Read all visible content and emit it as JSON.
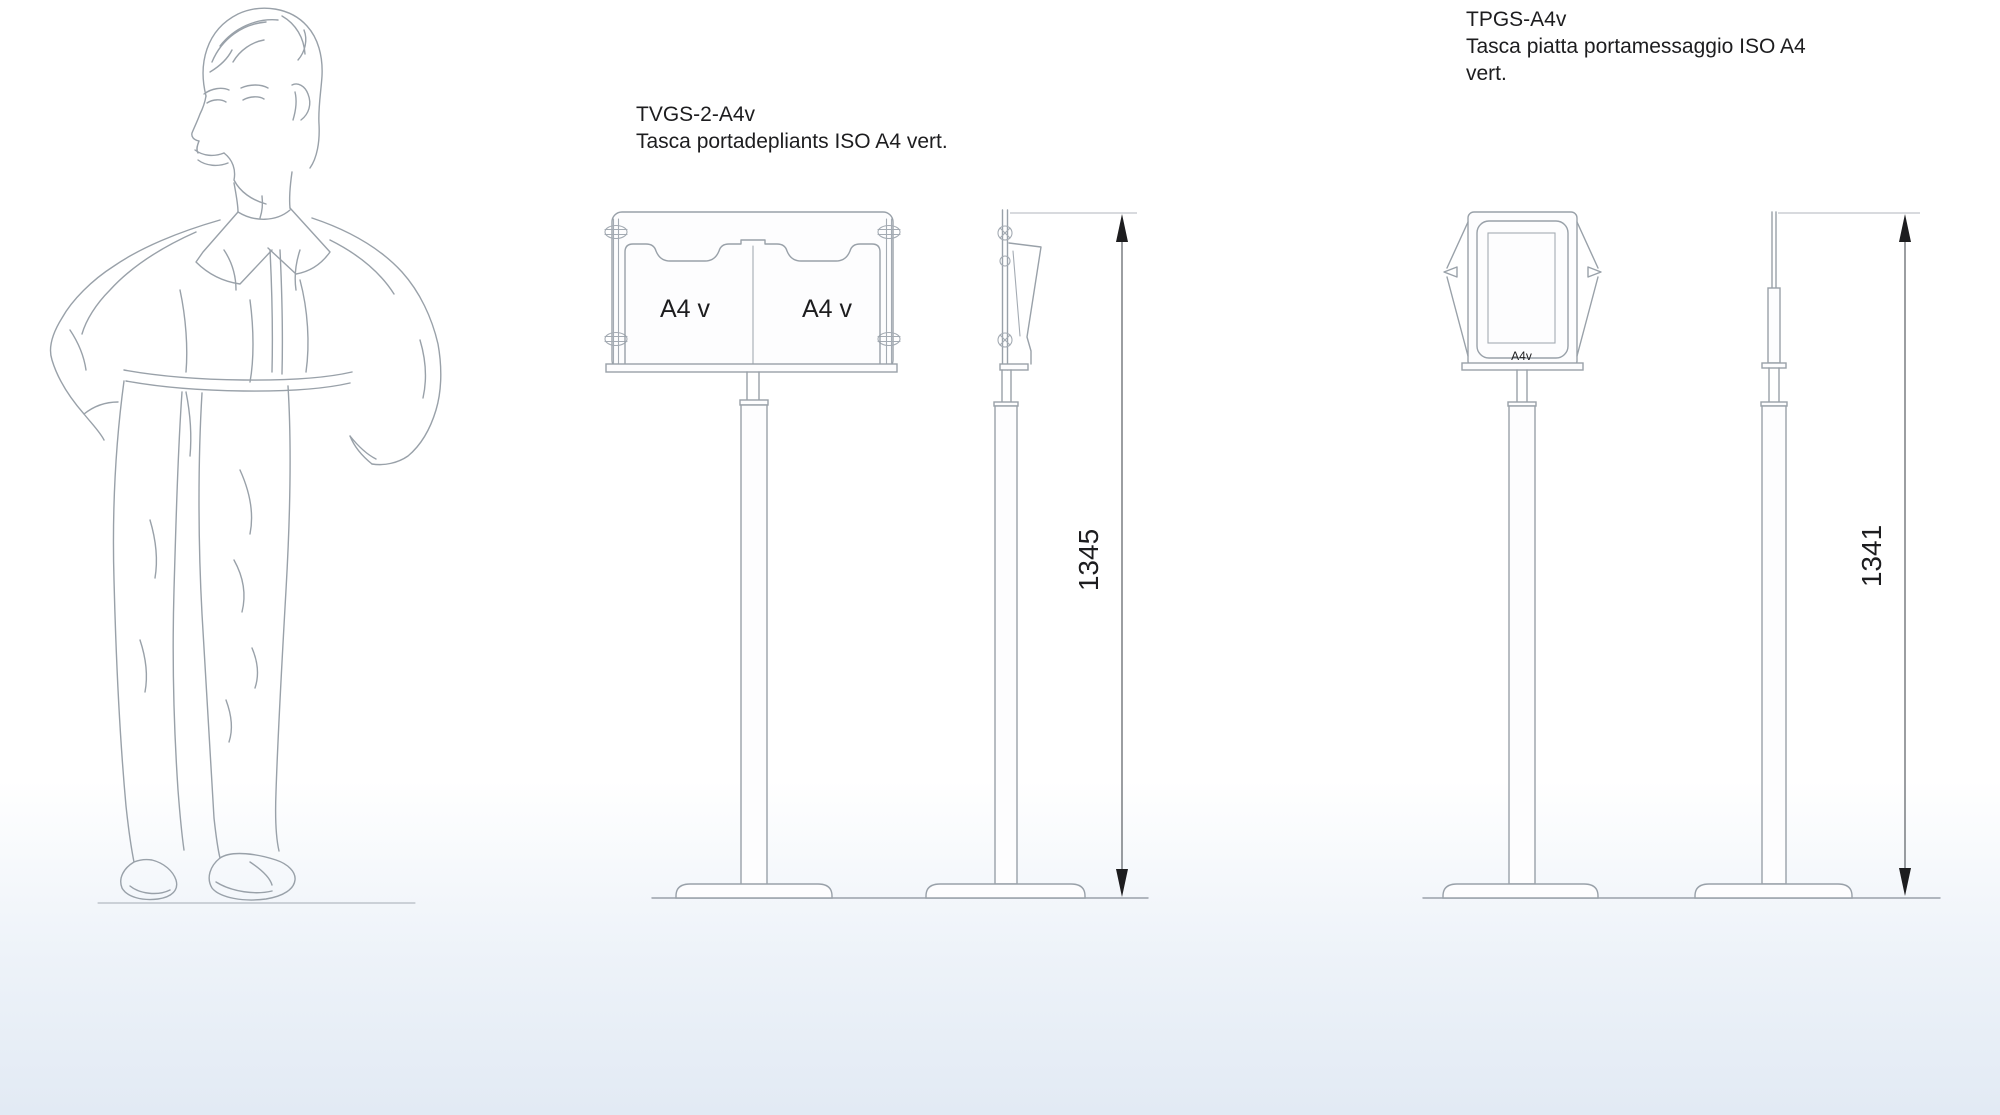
{
  "palette": {
    "background_top": "#ffffff",
    "background_bottom": "#e2eaf4",
    "line_color": "#99a1a9",
    "dimension_color": "#1d1d1f",
    "text_color": "#1d1d1f"
  },
  "products": [
    {
      "code": "TVGS-2-A4v",
      "description_lines": [
        "Tasca portadepliants ISO A4 vert."
      ],
      "pocket_labels": [
        "A4 v",
        "A4 v"
      ],
      "height_mm": "1345"
    },
    {
      "code": "TPGS-A4v",
      "description_lines": [
        "Tasca piatta portamessaggio ISO A4",
        "vert."
      ],
      "pocket_labels": [
        "A4v"
      ],
      "height_mm": "1341"
    }
  ]
}
